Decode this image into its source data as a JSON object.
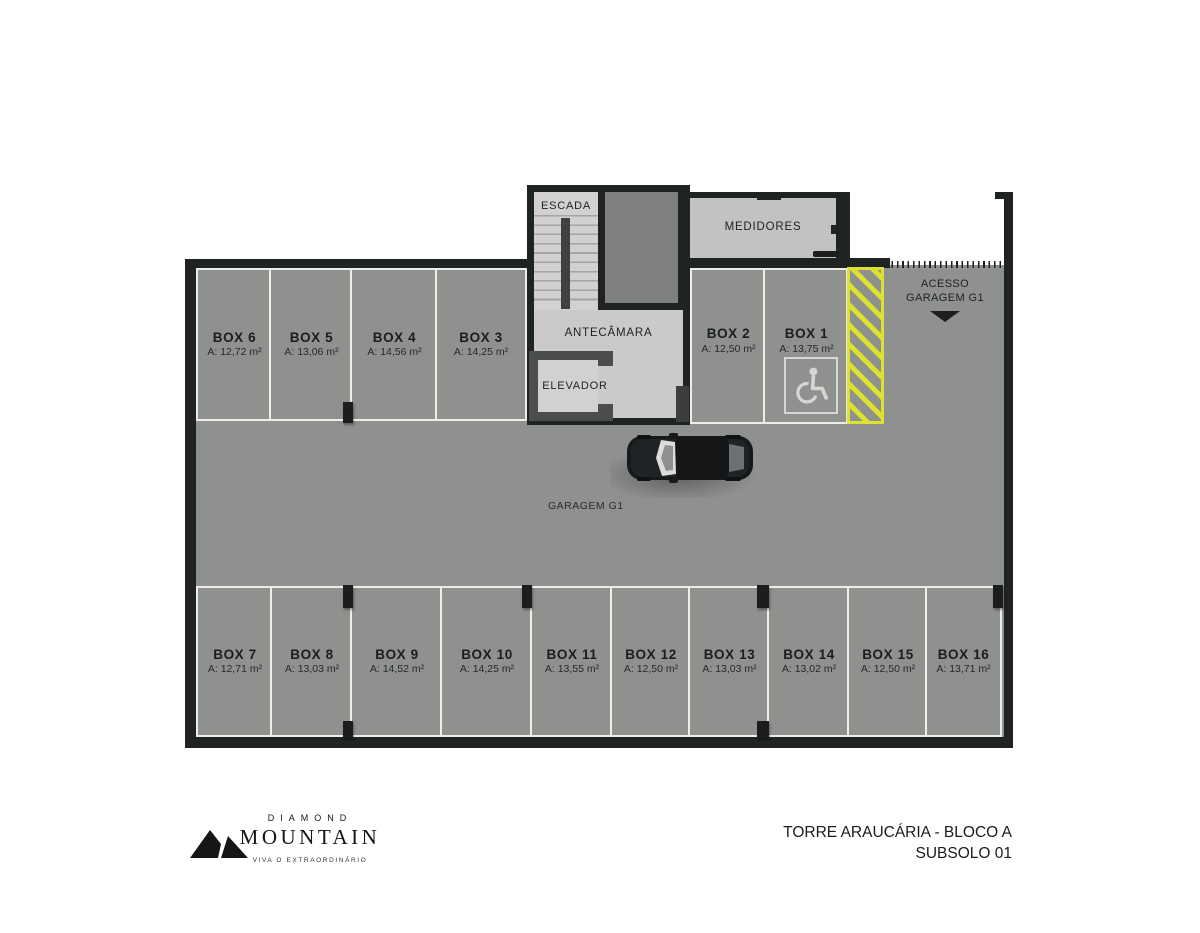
{
  "colors": {
    "floor": "#8f918e",
    "wall": "#202324",
    "marking_line": "#edeeea",
    "hatch_yellow": "#dde22e",
    "core_light": "#d2d1cf",
    "medidores_light": "#c2c2c0",
    "shaft_gray": "#7e817f",
    "elevator_wall": "#4b4e4d"
  },
  "plan": {
    "rooms": {
      "escada": "ESCADA",
      "medidores": "MEDIDORES",
      "antecamara": "ANTECÂMARA",
      "elevador": "ELEVADOR"
    },
    "garage_label": "GARAGEM G1",
    "access": {
      "line1": "ACESSO",
      "line2": "GARAGEM G1"
    },
    "top_boxes": [
      {
        "name": "BOX 6",
        "area": "A: 12,72 m²"
      },
      {
        "name": "BOX 5",
        "area": "A: 13,06 m²"
      },
      {
        "name": "BOX 4",
        "area": "A: 14,56 m²"
      },
      {
        "name": "BOX 3",
        "area": "A: 14,25 m²"
      }
    ],
    "upper_boxes": [
      {
        "name": "BOX 2",
        "area": "A: 12,50 m²"
      },
      {
        "name": "BOX 1",
        "area": "A: 13,75 m²"
      }
    ],
    "bottom_boxes": [
      {
        "name": "BOX 7",
        "area": "A: 12,71 m²"
      },
      {
        "name": "BOX 8",
        "area": "A: 13,03 m²"
      },
      {
        "name": "BOX 9",
        "area": "A: 14,52 m²"
      },
      {
        "name": "BOX 10",
        "area": "A: 14,25 m²"
      },
      {
        "name": "BOX 11",
        "area": "A: 13,55 m²"
      },
      {
        "name": "BOX 12",
        "area": "A: 12,50 m²"
      },
      {
        "name": "BOX 13",
        "area": "A: 13,03 m²"
      },
      {
        "name": "BOX 14",
        "area": "A: 13,02 m²"
      },
      {
        "name": "BOX 15",
        "area": "A: 12,50 m²"
      },
      {
        "name": "BOX 16",
        "area": "A: 13,71 m²"
      }
    ]
  },
  "footer": {
    "brand_top": "DIAMOND",
    "brand_name": "MOUNTAIN",
    "brand_tagline": "VIVA O EXTRAORDINÁRIO",
    "title_line1": "TORRE ARAUCÁRIA - BLOCO A",
    "title_line2": "SUBSOLO 01"
  }
}
